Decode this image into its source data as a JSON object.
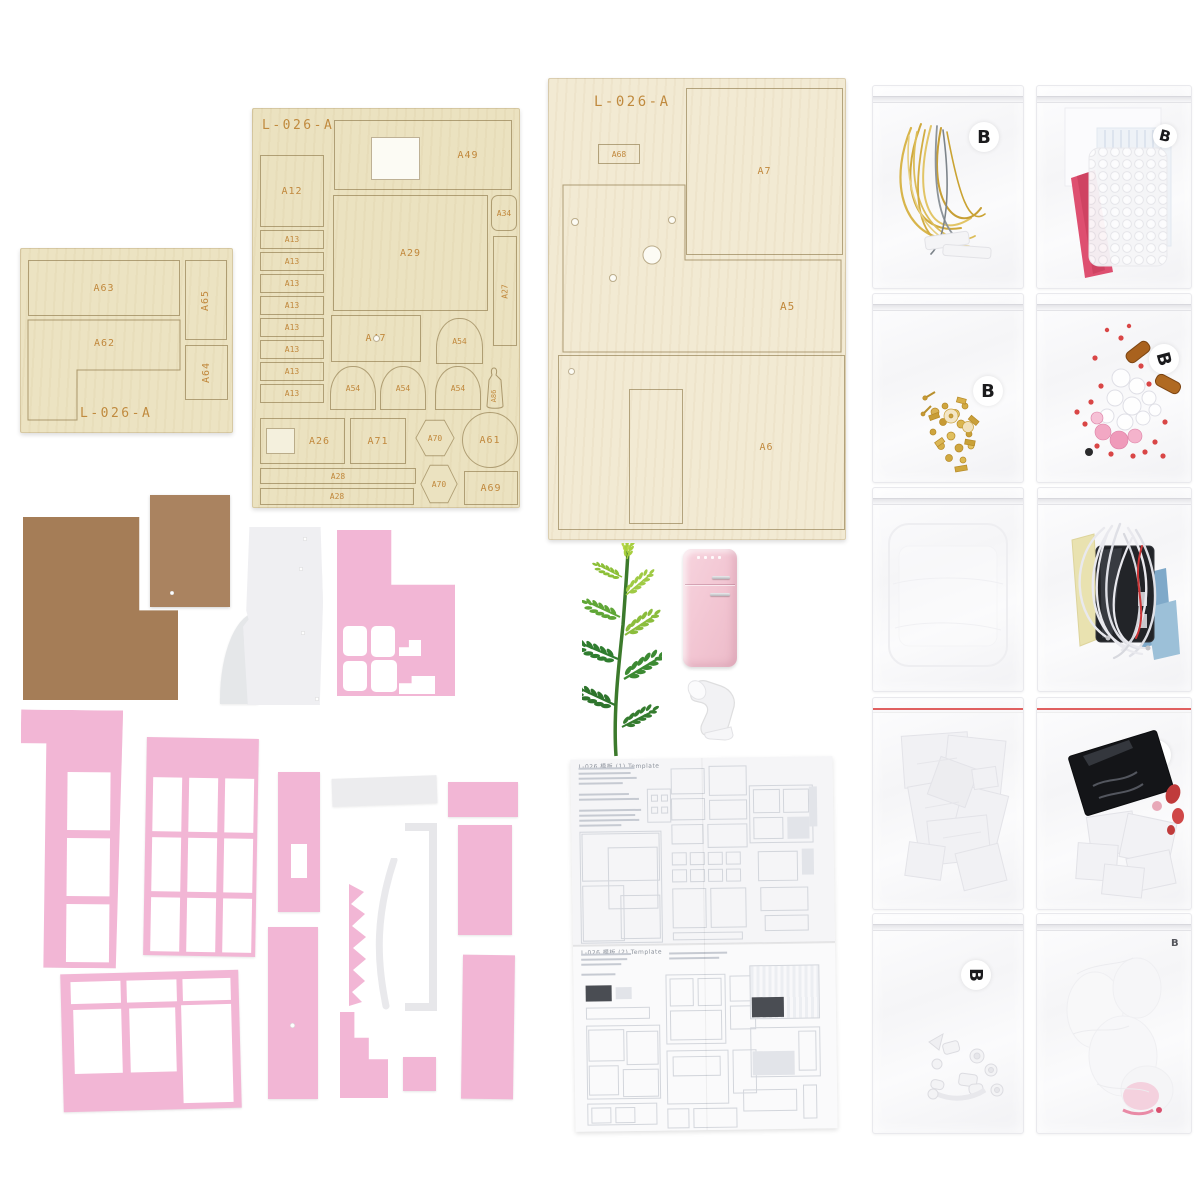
{
  "scene": {
    "description": "Flat-lay photo of a DIY miniature dollhouse kit: laser-cut plywood sheets, cardboard panels, pink painted window frames, a miniature fridge, a plastic tree, folded template sheet and zip bags of accessories"
  },
  "sheets": {
    "sheet1": {
      "code": "L-026-A",
      "parts": {
        "a63": "A63",
        "a62": "A62",
        "a65": "A65",
        "a64": "A64"
      }
    },
    "sheet2": {
      "code": "L-026-A",
      "parts": {
        "a12": "A12",
        "a13": "A13",
        "a49": "A49",
        "a29": "A29",
        "a34": "A34",
        "a27": "A27",
        "a47": "A47",
        "a54": "A54",
        "a86": "A86",
        "a26": "A26",
        "a71": "A71",
        "a70": "A70",
        "a61": "A61",
        "a69": "A69",
        "a28": "A28"
      }
    },
    "sheet3": {
      "code": "L-026-A",
      "parts": {
        "a68": "A68",
        "a7": "A7",
        "a5": "A5",
        "a6": "A6"
      }
    }
  },
  "manual": {
    "header_top": "L-026 模板 (1) Template",
    "header_bottom": "L-026 模板 (2) Template"
  },
  "bags": [
    {
      "label": "B",
      "contents": "gold-silver-wire"
    },
    {
      "label": "B",
      "contents": "bubble-wrap-paper-sheets"
    },
    {
      "label": "B",
      "contents": "gold-beads-hardware"
    },
    {
      "label": "B",
      "contents": "pink-clear-red-beads"
    },
    {
      "label": "",
      "contents": "clear-plastic-sheets"
    },
    {
      "label": "",
      "contents": "white-wires-battery-box"
    },
    {
      "label": "",
      "contents": "white-paper-parts"
    },
    {
      "label": "A",
      "contents": "black-sheet-white-parts"
    },
    {
      "label": "B",
      "contents": "white-plastic-fittings"
    },
    {
      "label": "B",
      "contents": "white-pink-soft-parts"
    }
  ],
  "colors": {
    "wood": "#ece3c2",
    "pink": "#f2b6d5",
    "engraving": "#c08a3e",
    "cardboard": "#a57d57"
  }
}
